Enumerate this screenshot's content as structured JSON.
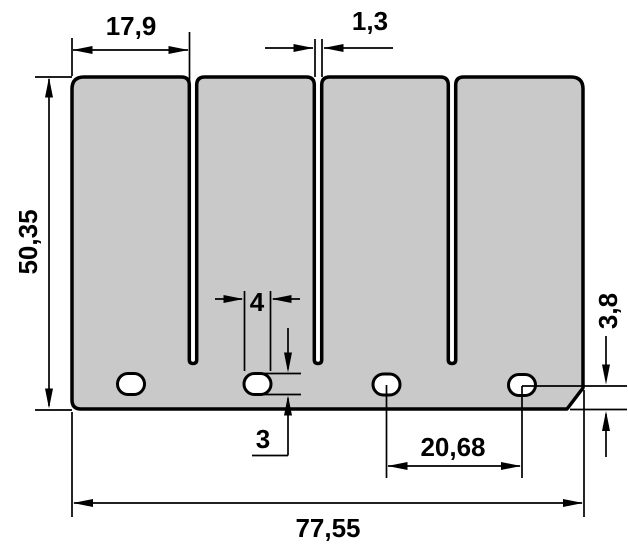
{
  "colors": {
    "plate_fill": "#c9c9c9",
    "line": "#000000",
    "background": "#ffffff"
  },
  "dimensions": {
    "petal_width": "17,9",
    "slot_width": "1,3",
    "overall_height": "50,35",
    "hole_width": "4",
    "hole_height": "3",
    "hole_center_to_bottom_edge": "3,8",
    "hole_spacing": "20,68",
    "overall_width": "77,55"
  }
}
